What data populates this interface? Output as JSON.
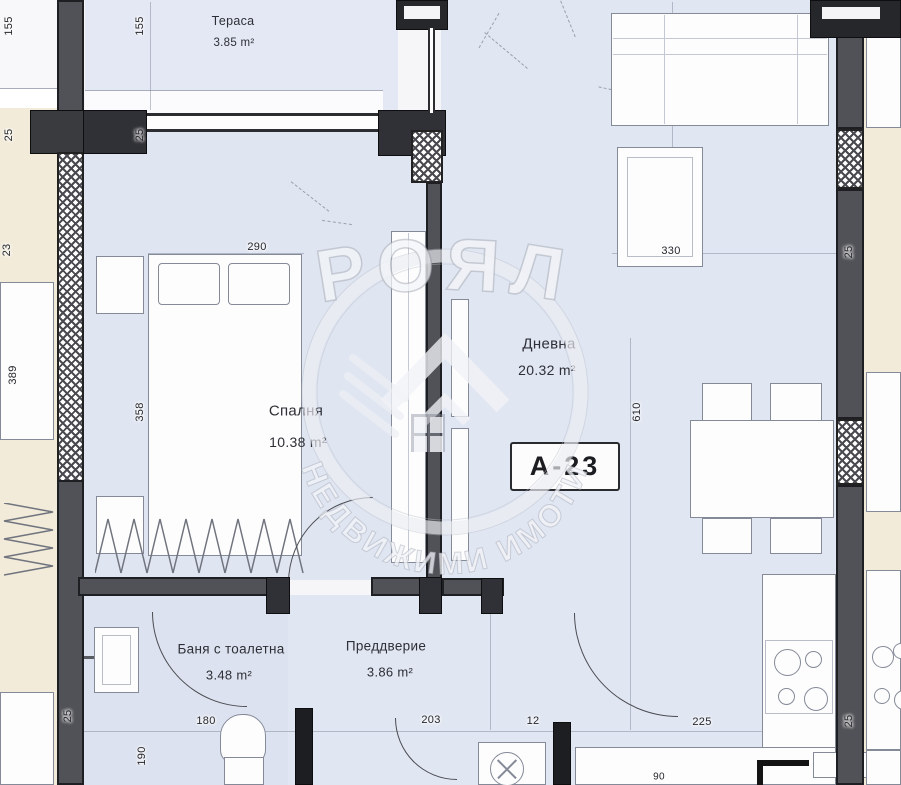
{
  "unit": {
    "label": "А-23"
  },
  "watermark": {
    "brand": "РОЯЛ",
    "subtitle": "НЕДВИЖИМИ ИМОТИ"
  },
  "rooms": [
    {
      "name": "Тераса",
      "area": "3.85 m²"
    },
    {
      "name": "Спалня",
      "area": "10.38 m²"
    },
    {
      "name": "Дневна",
      "area": "20.32 m²"
    },
    {
      "name": "Баня с тоалетна",
      "area": "3.48 m²"
    },
    {
      "name": "Преддверие",
      "area": "3.86 m²"
    }
  ],
  "dims": {
    "left_outer_155": "155",
    "left_inner_155": "155",
    "left_outer_25": "25",
    "left_inner_25": "25",
    "left_23": "23",
    "left_389": "389",
    "bedroom_358": "358",
    "bedroom_290": "290",
    "living_330": "330",
    "living_610": "610",
    "right_25_top": "25",
    "right_25_bottom": "25",
    "bottomleft_25": "25",
    "bath_190": "190",
    "bath_180": "180",
    "hall_203": "203",
    "wall_12": "12",
    "kitchen_225": "225",
    "kitchen_90": "90"
  },
  "colors": {
    "floor": "#e0e6f2",
    "wall": "#515257",
    "adjacent_unit": "#f2ebd9",
    "ink": "#26272c",
    "watermark_gray": "#9aa0ac"
  }
}
